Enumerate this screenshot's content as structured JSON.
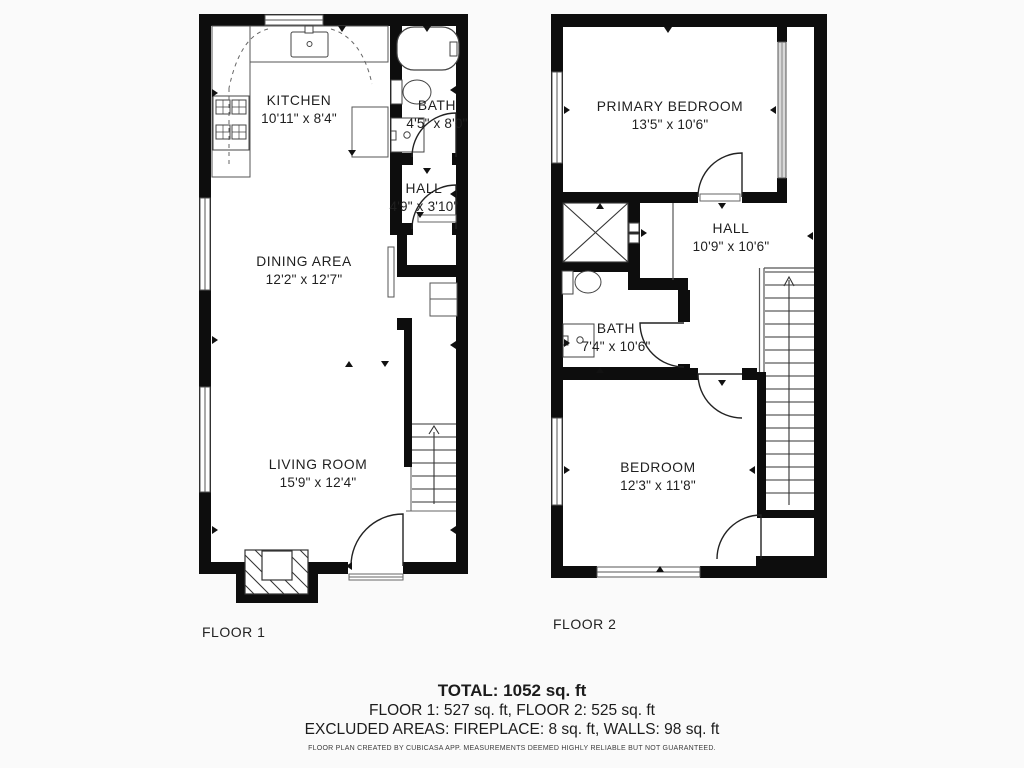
{
  "floors": [
    {
      "label": "FLOOR 1",
      "rooms": [
        {
          "name": "KITCHEN",
          "dims": "10'11\" x 8'4\""
        },
        {
          "name": "BATH",
          "dims": "4'5\" x 8'0\""
        },
        {
          "name": "HALL",
          "dims": "4'9\" x 3'10\""
        },
        {
          "name": "DINING AREA",
          "dims": "12'2\" x 12'7\""
        },
        {
          "name": "LIVING ROOM",
          "dims": "15'9\" x 12'4\""
        }
      ]
    },
    {
      "label": "FLOOR 2",
      "rooms": [
        {
          "name": "PRIMARY BEDROOM",
          "dims": "13'5\" x 10'6\""
        },
        {
          "name": "HALL",
          "dims": "10'9\" x 10'6\""
        },
        {
          "name": "BATH",
          "dims": "7'4\" x 10'6\""
        },
        {
          "name": "BEDROOM",
          "dims": "12'3\" x 11'8\""
        }
      ]
    }
  ],
  "summary": {
    "total": "TOTAL: 1052 sq. ft",
    "floors_line": "FLOOR 1: 527 sq. ft, FLOOR 2: 525 sq. ft",
    "excluded_line": "EXCLUDED AREAS: FIREPLACE: 8 sq. ft, WALLS: 98 sq. ft",
    "disclaimer": "FLOOR PLAN CREATED BY CUBICASA APP. MEASUREMENTS DEEMED HIGHLY RELIABLE BUT NOT GUARANTEED."
  },
  "colors": {
    "wall": "#0d0d0d",
    "background": "#fafafa",
    "text": "#1f1f1f"
  }
}
